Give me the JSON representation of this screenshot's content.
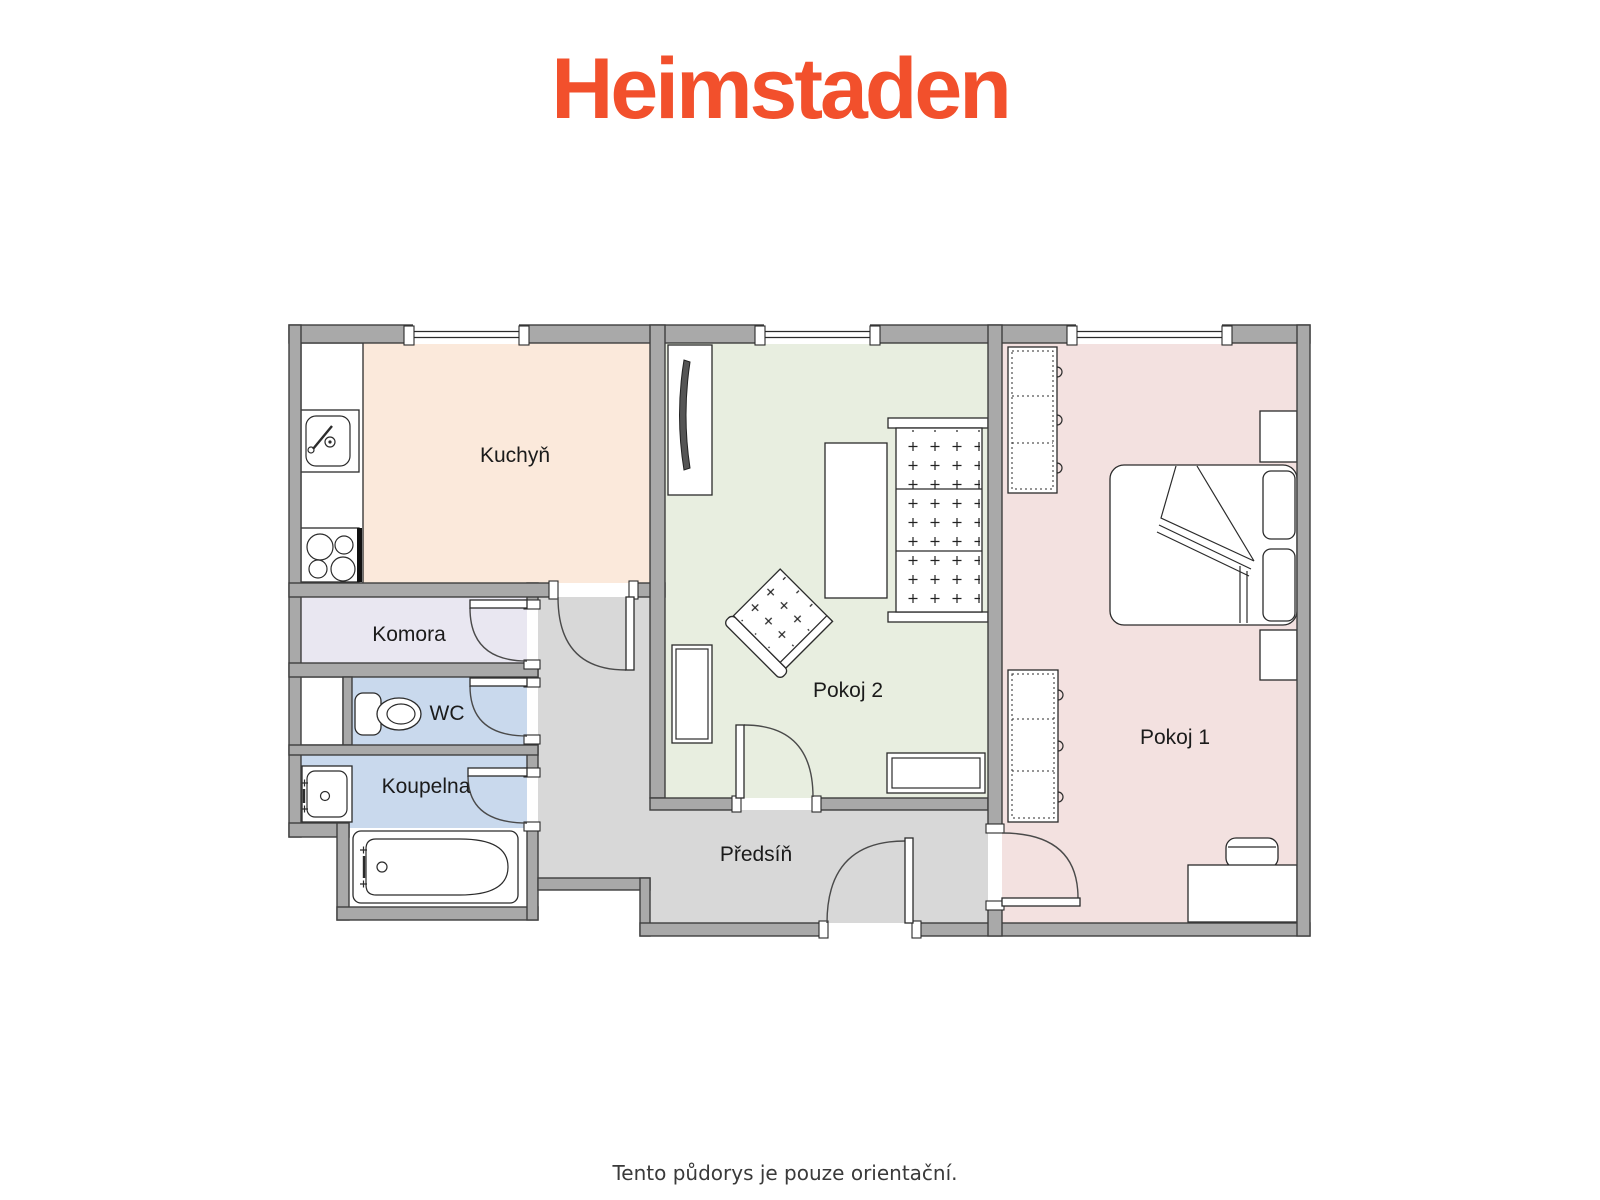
{
  "header": {
    "logo": "Heimstaden",
    "logo_color": "#F2502C"
  },
  "plan": {
    "wall_color": "#A9A9A9",
    "rooms": {
      "kuchyn": {
        "label": "Kuchyň",
        "color": "#FBE9DB"
      },
      "komora": {
        "label": "Komora",
        "color": "#E9E7F1"
      },
      "wc": {
        "label": "WC",
        "color": "#C9D9ED"
      },
      "koupelna": {
        "label": "Koupelna",
        "color": "#C9D9ED"
      },
      "pokoj2": {
        "label": "Pokoj 2",
        "color": "#E8EEE0"
      },
      "pokoj1": {
        "label": "Pokoj 1",
        "color": "#F3E1E0"
      },
      "predsin": {
        "label": "Předsíň",
        "color": "#D8D8D8"
      }
    }
  },
  "footer": {
    "disclaimer": "Tento půdorys je pouze orientační."
  }
}
